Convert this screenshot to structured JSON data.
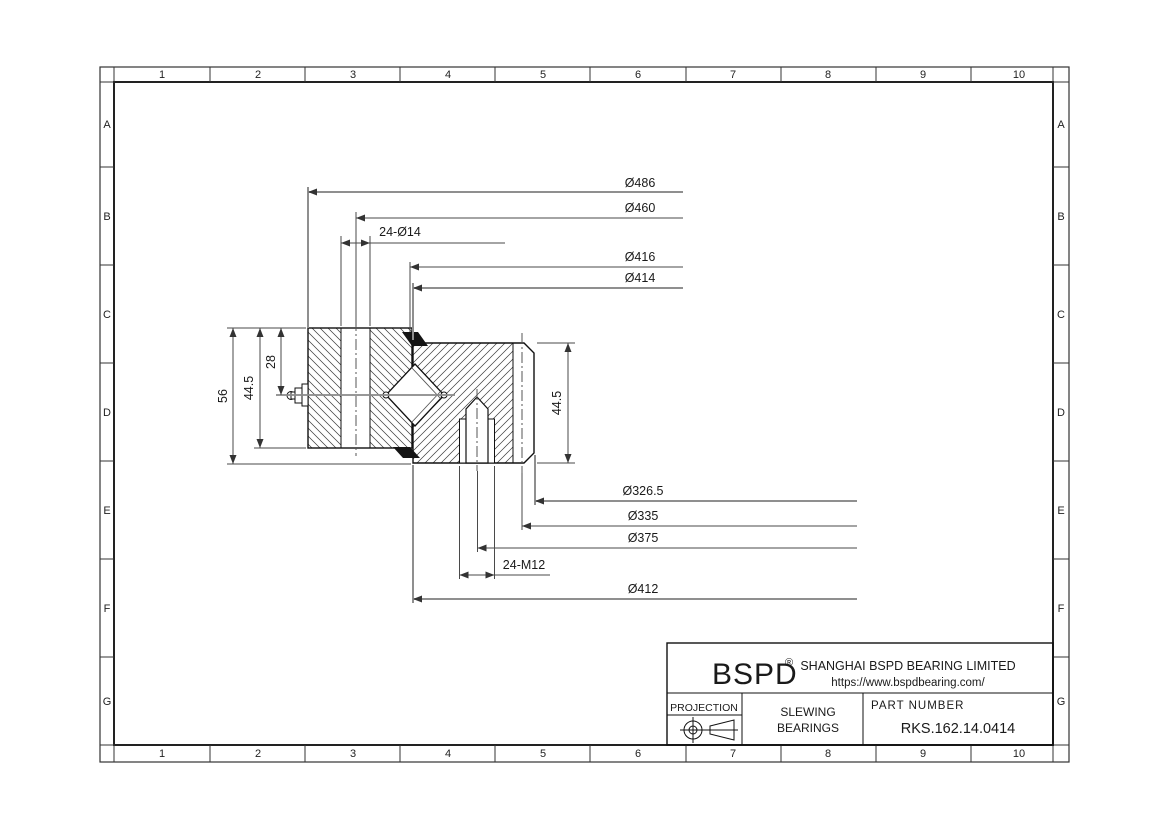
{
  "sheet": {
    "grid": {
      "columns": [
        "1",
        "2",
        "3",
        "4",
        "5",
        "6",
        "7",
        "8",
        "9",
        "10"
      ],
      "rows": [
        "A",
        "B",
        "C",
        "D",
        "E",
        "F",
        "G"
      ]
    }
  },
  "dimensions": {
    "d486": "Ø486",
    "d460": "Ø460",
    "holes14": "24-Ø14",
    "d416": "Ø416",
    "d414": "Ø414",
    "d326": "Ø326.5",
    "d335": "Ø335",
    "d375": "Ø375",
    "holesM12": "24-M12",
    "d412": "Ø412",
    "h56": "56",
    "h44_5_left": "44.5",
    "h28": "28",
    "h44_5_right": "44.5"
  },
  "title_block": {
    "brand": "BSPD",
    "registered": "®",
    "company": "SHANGHAI BSPD BEARING LIMITED",
    "website": "https://www.bspdbearing.com/",
    "projection_label": "PROJECTION",
    "product_line1": "SLEWING",
    "product_line2": "BEARINGS",
    "part_number_label": "PART  NUMBER",
    "part_number": "RKS.162.14.0414"
  }
}
